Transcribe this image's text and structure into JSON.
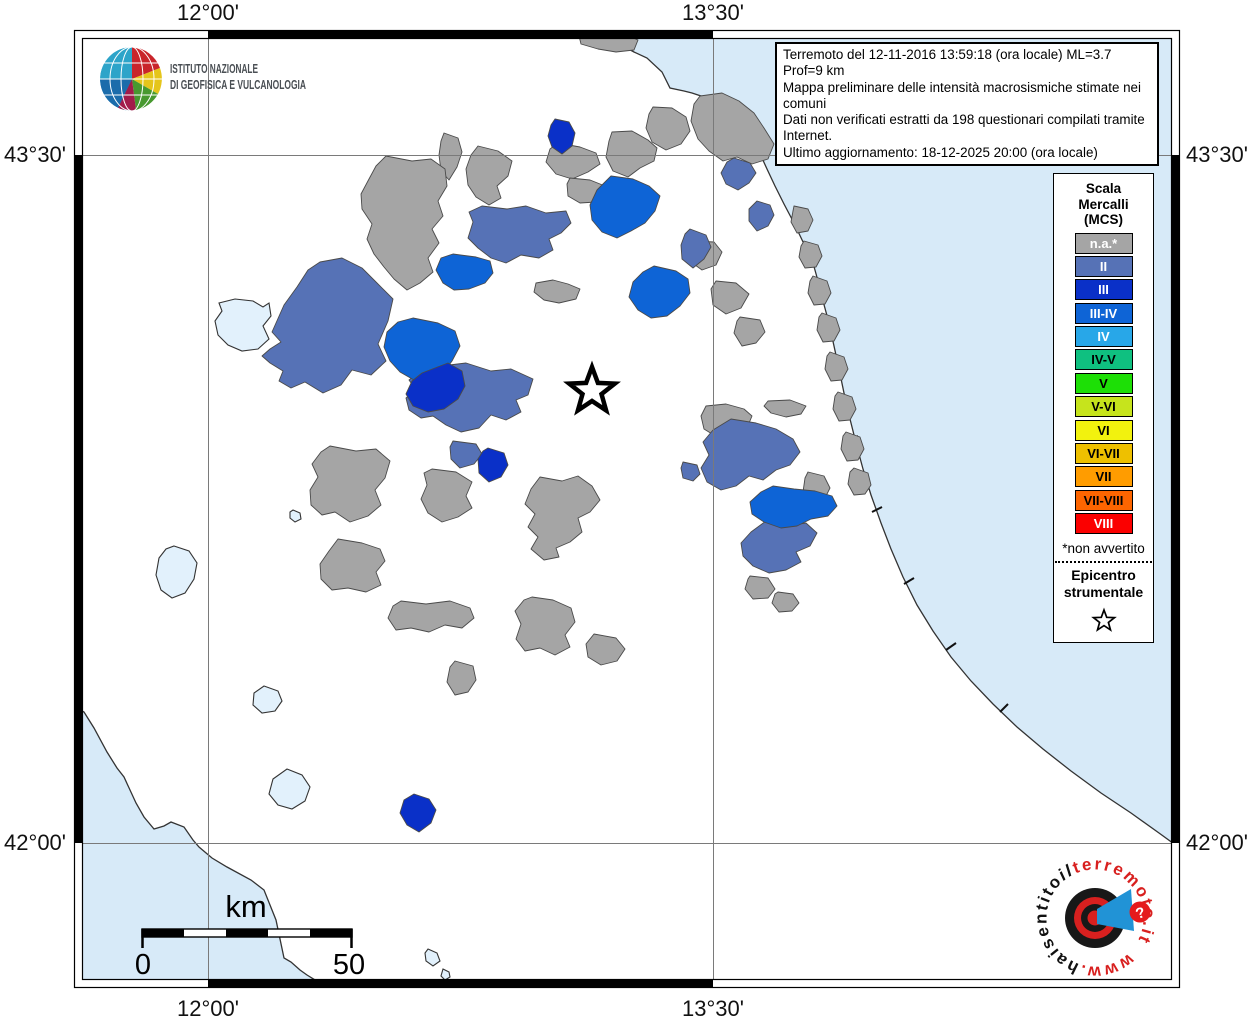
{
  "ingv": {
    "name_line1": "ISTITUTO NAZIONALE",
    "name_line2": "DI GEOFISICA E VULCANOLOGIA"
  },
  "info_box": {
    "lines": [
      "Terremoto del 12-11-2016 13:59:18 (ora locale) ML=3.7 Prof=9 km",
      "Mappa preliminare delle intensità macrosismiche stimate nei comuni",
      "Dati non verificati estratti da 198 questionari compilati tramite Internet.",
      "Ultimo aggiornamento: 18-12-2025 20:00 (ora locale)"
    ]
  },
  "grid_labels": {
    "lon_west": "12°00'",
    "lon_east": "13°30'",
    "lat_north": "43°30'",
    "lat_south": "42°00'"
  },
  "legend": {
    "title_lines": [
      "Scala",
      "Mercalli",
      "(MCS)"
    ],
    "items": [
      {
        "label": "n.a.*",
        "color": "#a5a5a5",
        "text_color": "#ffffff"
      },
      {
        "label": "II",
        "color": "#5672b6",
        "text_color": "#ffffff"
      },
      {
        "label": "III",
        "color": "#0a30c8",
        "text_color": "#ffffff"
      },
      {
        "label": "III-IV",
        "color": "#0e64d6",
        "text_color": "#ffffff"
      },
      {
        "label": "IV",
        "color": "#28a7e8",
        "text_color": "#ffffff"
      },
      {
        "label": "IV-V",
        "color": "#0fc080",
        "text_color": "#000000"
      },
      {
        "label": "V",
        "color": "#1ddf06",
        "text_color": "#000000"
      },
      {
        "label": "V-VI",
        "color": "#c6e41c",
        "text_color": "#000000"
      },
      {
        "label": "VI",
        "color": "#f2f20e",
        "text_color": "#000000"
      },
      {
        "label": "VI-VII",
        "color": "#eec000",
        "text_color": "#000000"
      },
      {
        "label": "VII",
        "color": "#ff9c00",
        "text_color": "#000000"
      },
      {
        "label": "VII-VIII",
        "color": "#fd6500",
        "text_color": "#000000"
      },
      {
        "label": "VIII",
        "color": "#fb0000",
        "text_color": "#ffffff"
      }
    ],
    "footnote": "*non avvertito",
    "epicenter_lines": [
      "Epicentro",
      "strumentale"
    ]
  },
  "scale_bar": {
    "unit_label": "km",
    "min_label": "0",
    "max_label": "50"
  },
  "site_logo": {
    "www": "www.",
    "name_black": "haisentito",
    "name_mid": "il",
    "name_red": "terremoto.it",
    "badge": "?"
  },
  "map": {
    "sea_color": "#d7eaf8",
    "lake_color": "#e2f1fc",
    "land_color": "#ffffff",
    "colors": {
      "na": "#a5a5a5",
      "ii": "#5672b6",
      "iii": "#0a30c8",
      "iii_iv": "#0e64d6"
    },
    "adriatic_d": "M 600,30 L 612,40 L 634,52 L 647,58 L 662,72 L 670,88 L 684,91 L 692,93 L 704,97 L 710,101 L 716,98 L 723,99 L 731,106 L 739,112 L 749,123 L 757,132 L 760,141 L 757,150 L 762,158 L 767,169 L 775,186 L 784,204 L 794,223 L 804,244 L 813,263 L 818,281 L 823,301 L 829,323 L 834,346 L 839,369 L 844,393 L 850,419 L 856,443 L 863,469 L 871,495 L 881,523 L 891,549 L 903,577 L 917,605 L 933,631 L 951,657 L 971,681 L 993,704 L 1017,727 L 1043,749 L 1071,771 L 1101,793 L 1131,813 L 1159,833 L 1181,849 L 1181,29 Z",
    "adriatic_coast_d": "M 600,30 L 612,40 L 634,52 L 647,58 L 662,72 L 670,88 L 684,91 L 692,93 L 704,97 L 710,101 L 716,98 L 723,99 L 731,106 L 739,112 L 749,123 L 757,132 L 760,141 L 757,150 L 762,158 L 767,169 L 775,186 L 784,204 L 794,223 L 804,244 L 813,263 L 818,281 L 823,301 L 829,323 L 834,346 L 839,369 L 844,393 L 850,419 L 856,443 L 863,469 L 871,495 L 881,523 L 891,549 L 903,577 L 917,605 L 933,631 L 951,657 L 971,681 L 993,704 L 1017,727 L 1043,749 L 1071,771 L 1101,793 L 1131,813 L 1159,833 L 1181,849",
    "tyrrhenian_d": "M 73,706 L 84,712 L 94,728 L 107,752 L 117,768 L 124,777 L 136,803 L 144,817 L 154,829 L 164,826 L 171,822 L 184,827 L 193,840 L 199,847 L 212,858 L 227,867 L 251,880 L 264,890 L 270,905 L 276,920 L 284,958 L 291,962 L 300,970 L 307,975 L 320,983 L 334,989 L 73,989 Z",
    "tyrrhenian_coast_d": "M 73,706 L 84,712 L 94,728 L 107,752 L 117,768 L 124,777 L 136,803 L 144,817 L 154,829 L 164,826 L 171,822 L 184,827 L 193,840 L 199,847 L 212,858 L 227,867 L 251,880 L 264,890 L 270,905 L 276,920 L 284,958 L 291,962 L 300,970 L 307,975 L 320,983 L 334,989",
    "coast_ticks_d": "M848,440 l10,-4 M872,512 l10,-5 M904,584 l10,-6 M946,650 l10,-7 M1000,712 l8,-8",
    "polygons": [
      {
        "c": "na",
        "pts": "578,32 600,30 622,33 638,40 634,50 616,52 598,49 581,44"
      },
      {
        "c": "na",
        "pts": "653,107 672,108 686,117 690,131 681,144 666,150 652,142 646,128 649,114"
      },
      {
        "c": "na",
        "pts": "700,96 722,93 739,101 754,113 764,128 774,144 768,159 752,164 737,157 723,161 709,151 698,139 691,121 694,104"
      },
      {
        "c": "na",
        "pts": "612,132 632,131 648,140 657,148 654,161 640,168 628,177 613,171 606,157 609,141"
      },
      {
        "c": "na",
        "pts": "558,143 580,147 596,153 600,164 588,172 572,179 556,174 546,162 550,149"
      },
      {
        "c": "na",
        "pts": "570,178 590,180 605,186 610,196 596,202 580,203 568,196 567,184"
      },
      {
        "c": "na",
        "pts": "444,133 458,138 462,152 457,167 449,180 441,171 439,155 441,141"
      },
      {
        "c": "na",
        "pts": "478,146 498,151 512,161 508,176 497,186 501,198 489,205 476,197 468,185 466,169 471,155"
      },
      {
        "c": "na",
        "pts": "386,156 412,161 431,159 445,169 447,186 438,201 443,216 432,229 439,243 428,258 433,272 420,283 407,290 394,279 384,267 374,254 367,239 372,224 362,209 361,194 369,179 376,166"
      },
      {
        "c": "na",
        "pts": "536,283 553,280 568,284 580,289 576,299 559,303 544,300 534,292"
      },
      {
        "c": "na",
        "pts": "694,241 714,242 722,252 716,265 702,270 691,262 691,248"
      },
      {
        "c": "na",
        "pts": "716,281 736,283 749,294 741,308 726,314 713,305 711,289"
      },
      {
        "c": "na",
        "pts": "740,317 760,320 765,332 756,343 742,346 734,333 737,321"
      },
      {
        "c": "na",
        "pts": "794,206 808,209 813,220 808,231 797,233 791,222 793,211"
      },
      {
        "c": "na",
        "pts": "804,241 818,245 822,256 816,267 805,268 799,257 801,246"
      },
      {
        "c": "na",
        "pts": "813,276 827,281 831,293 825,304 814,305 808,293 810,281"
      },
      {
        "c": "na",
        "pts": "822,313 836,318 840,330 834,341 823,342 817,330 819,317"
      },
      {
        "c": "na",
        "pts": "830,352 844,357 848,369 842,380 831,381 825,369 827,356"
      },
      {
        "c": "na",
        "pts": "838,392 852,397 856,409 850,420 839,421 833,409 835,396"
      },
      {
        "c": "na",
        "pts": "846,432 860,437 864,449 858,460 847,461 841,449 843,436"
      },
      {
        "c": "na",
        "pts": "854,468 868,473 871,485 865,494 854,495 848,484 850,472"
      },
      {
        "c": "na",
        "pts": "706,406 726,404 744,409 752,416 747,428 731,431 717,437 704,429 701,416"
      },
      {
        "c": "na",
        "pts": "768,401 790,400 806,406 801,414 786,417 771,413 764,406"
      },
      {
        "c": "na",
        "pts": "808,472 824,476 830,488 824,500 812,503 803,492 805,478"
      },
      {
        "c": "na",
        "pts": "330,446 356,451 376,449 390,461 385,478 375,490 381,505 368,516 350,522 335,512 322,515 311,505 310,490 318,477 312,464 321,452"
      },
      {
        "c": "na",
        "pts": "432,469 456,472 472,482 466,496 472,508 458,517 442,522 428,513 421,499 427,485 424,473"
      },
      {
        "c": "na",
        "pts": "338,539 362,543 380,549 385,561 376,572 381,585 366,592 348,588 332,590 321,579 320,564 329,551"
      },
      {
        "c": "na",
        "pts": "540,477 562,481 578,476 592,486 600,500 590,512 578,518 582,532 570,542 556,548 559,557 544,560 531,549 538,537 528,527 535,514 525,504 531,489"
      },
      {
        "c": "na",
        "pts": "532,597 553,600 571,608 575,622 565,635 570,647 555,655 540,648 525,651 516,639 521,624 515,611 524,600"
      },
      {
        "c": "na",
        "pts": "594,634 616,638 625,649 617,661 601,665 588,657 586,644"
      },
      {
        "c": "na",
        "pts": "401,601 426,604 450,601 470,608 474,618 462,628 445,625 429,632 411,628 396,630 388,618 393,606"
      },
      {
        "c": "na",
        "pts": "455,661 473,666 476,680 468,692 455,695 447,682 450,667"
      },
      {
        "c": "na",
        "pts": "750,576 768,578 775,589 768,598 753,599 745,589 748,579"
      },
      {
        "c": "na",
        "pts": "778,592 793,594 799,603 792,611 779,612 772,603 775,594"
      },
      {
        "c": "ii",
        "pts": "320,262 342,258 362,268 376,282 393,299 388,321 378,344 386,361 371,375 352,370 341,385 323,393 305,382 291,388 279,381 283,371 270,363 262,356 270,349 281,342 272,332 284,305 297,287 308,270"
      },
      {
        "c": "ii",
        "pts": "482,206 507,209 526,206 546,213 566,211 571,223 561,233 549,239 553,250 539,258 521,255 506,263 491,258 478,248 468,238 473,222 469,212"
      },
      {
        "c": "ii",
        "pts": "441,366 466,363 491,371 511,369 533,379 528,395 516,400 521,412 506,420 491,415 479,428 461,432 446,425 433,416 421,418 409,410 406,398 416,390 409,380 421,371"
      },
      {
        "c": "ii",
        "pts": "734,158 750,163 756,173 749,183 738,190 726,184 721,173 727,162"
      },
      {
        "c": "ii",
        "pts": "757,201 770,205 774,215 768,226 757,231 749,221 749,209"
      },
      {
        "c": "ii",
        "pts": "690,229 706,235 711,247 704,259 693,268 682,259 681,245 685,234"
      },
      {
        "c": "ii",
        "pts": "731,419 756,423 776,429 793,439 800,452 790,465 776,470 763,480 749,476 736,486 721,490 707,482 701,468 709,455 703,442 713,430"
      },
      {
        "c": "ii",
        "pts": "766,521 786,526 806,523 817,533 810,546 796,552 801,562 786,570 769,573 753,566 743,556 741,543 751,532"
      },
      {
        "c": "ii",
        "pts": "683,462 697,465 700,474 693,481 683,478 681,468"
      },
      {
        "c": "ii",
        "pts": "453,441 476,444 482,454 474,464 460,468 451,459 450,447"
      },
      {
        "c": "iii_iv",
        "pts": "611,176 633,179 649,186 660,196 655,211 645,223 631,231 617,238 602,232 592,220 590,205 597,190"
      },
      {
        "c": "iii_iv",
        "pts": "654,266 676,271 688,279 690,293 680,306 667,316 651,318 638,310 629,297 633,282 643,272"
      },
      {
        "c": "iii_iv",
        "pts": "453,254 476,257 490,261 493,273 485,283 469,289 454,290 443,283 436,270 441,258"
      },
      {
        "c": "iii_iv",
        "pts": "413,318 438,323 455,331 460,346 452,361 444,372 429,378 414,380 400,372 390,361 384,347 387,332 398,322"
      },
      {
        "c": "iii_iv",
        "pts": "773,486 794,489 815,491 832,496 837,506 828,516 811,519 797,526 781,528 764,522 752,514 750,502 761,492"
      },
      {
        "c": "iii",
        "pts": "555,119 569,122 575,133 572,146 562,154 552,147 548,136 551,125"
      },
      {
        "c": "iii",
        "pts": "448,363 462,371 465,386 458,399 444,409 428,412 413,406 406,394 412,381 422,373 435,368"
      },
      {
        "c": "iii",
        "pts": "488,448 504,453 508,465 501,477 489,482 479,473 478,459 483,451"
      },
      {
        "c": "iii",
        "pts": "414,794 429,799 436,810 431,823 419,832 407,825 400,813 404,800"
      }
    ],
    "lakes": [
      "235,299 253,301 263,307 269,303 271,316 263,326 269,339 258,349 242,351 228,345 218,335 215,321 222,311 219,303",
      "174,546 189,551 197,563 194,579 185,593 172,598 161,590 156,575 159,558 166,549",
      "264,686 278,691 282,701 275,711 262,713 253,705 254,693",
      "287,769 302,775 310,787 305,801 292,809 278,805 269,794 273,779",
      "293,510 300,513 301,519 295,522 290,518 290,512",
      "428,949 437,953 440,961 433,966 426,961 425,953",
      "443,969 449,972 450,977 445,980 441,976"
    ]
  }
}
